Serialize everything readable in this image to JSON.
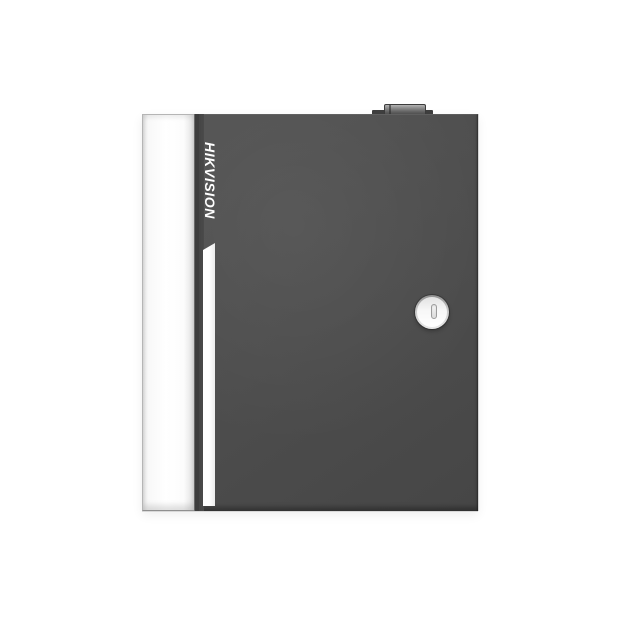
{
  "scene": {
    "type": "product-photo",
    "background_color": "#ffffff"
  },
  "device": {
    "brand_label": "HIKVISION",
    "colors": {
      "background": "#ffffff",
      "door_face": "#4d4d4d",
      "door_seam": "#3e3e3e",
      "side_panel": "#fcfcfc",
      "panel_edge": "#b5b5b5",
      "accent_stripe": "#ffffff",
      "brand_text": "#ffffff",
      "lock_rim": "#8f8f8f",
      "lock_face": "#f7f7f7",
      "keyhole_fill": "#dcdcdc",
      "keyhole_border": "#9c9c9c",
      "protrusion_top": "#b4b4b4",
      "protrusion_dark": "#3f3f3f",
      "bottom_edge": "#d8d8d8"
    }
  }
}
